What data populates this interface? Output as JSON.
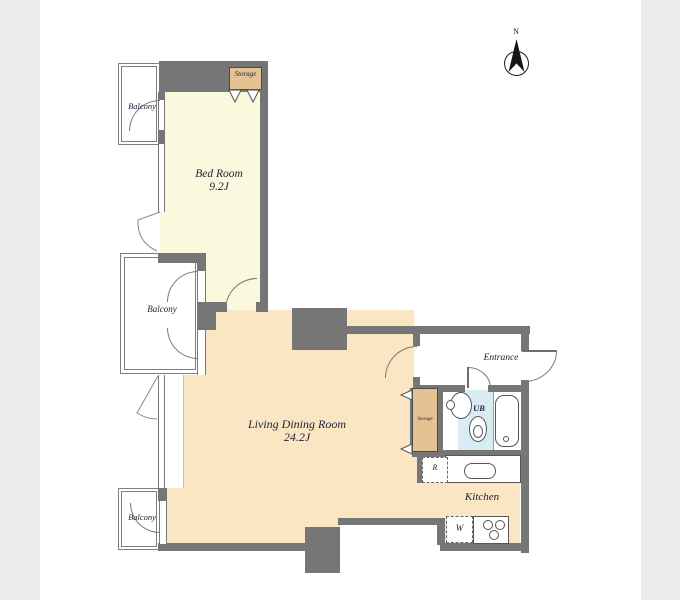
{
  "page": {
    "background": "#ffffff",
    "side_band_color": "#ececec"
  },
  "palette": {
    "wall": "#767676",
    "bedroom_fill": "#faf8dd",
    "living_fill": "#fae6c3",
    "storage_fill": "#e4c292",
    "unit_bath_fill": "#d9ecf3",
    "outline": "#7a7a7a",
    "text": "#22223a"
  },
  "compass": {
    "north": "N"
  },
  "labels": {
    "bedroom_name": "Bed Room",
    "bedroom_size": "9.2J",
    "living_name": "Living Dining Room",
    "living_size": "24.2J",
    "kitchen": "Kitchen",
    "entrance": "Entrance",
    "unit_bath": "UB",
    "storage_top": "Storage",
    "storage_hall": "Storage",
    "balcony_top": "Balcony",
    "balcony_middle": "Balcony",
    "balcony_bottom": "Balcony",
    "refrigerator": "R",
    "washer": "W"
  }
}
